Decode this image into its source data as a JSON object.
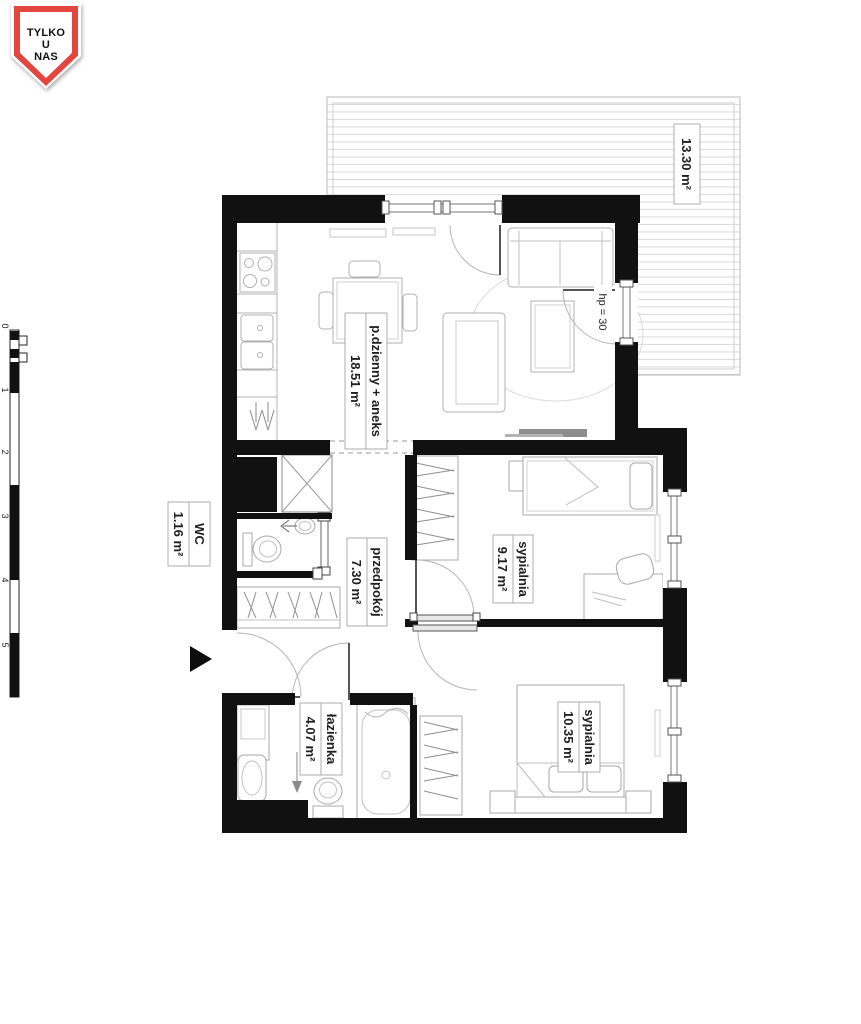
{
  "badge": {
    "lines": [
      "TYLKO",
      "U",
      "NAS"
    ]
  },
  "rooms": {
    "balcony": {
      "area": "13.30 m²"
    },
    "living": {
      "name": "p.dzienny + aneks",
      "area": "18.51 m²"
    },
    "wc": {
      "name": "WC",
      "area": "1.16 m²"
    },
    "hallway": {
      "name": "przedpokój",
      "area": "7.30 m²"
    },
    "bedroom1": {
      "name": "sypialnia",
      "area": "9.17 m²"
    },
    "bedroom2": {
      "name": "sypialnia",
      "area": "10.35 m²"
    },
    "bathroom": {
      "name": "łazienka",
      "area": "4.07 m²"
    },
    "window_note": "hp = 30"
  },
  "scale_bar": {
    "labels": [
      "0",
      "1",
      "2",
      "3",
      "4",
      "5"
    ]
  },
  "colors": {
    "wall": "#111111",
    "badge_red": "#e2463f",
    "deck_line": "#dcdcdc",
    "furniture_line": "#b0b0b0",
    "tv_stand": "#8c8c8c",
    "label_border": "#999999",
    "text": "#1f1f1f"
  }
}
